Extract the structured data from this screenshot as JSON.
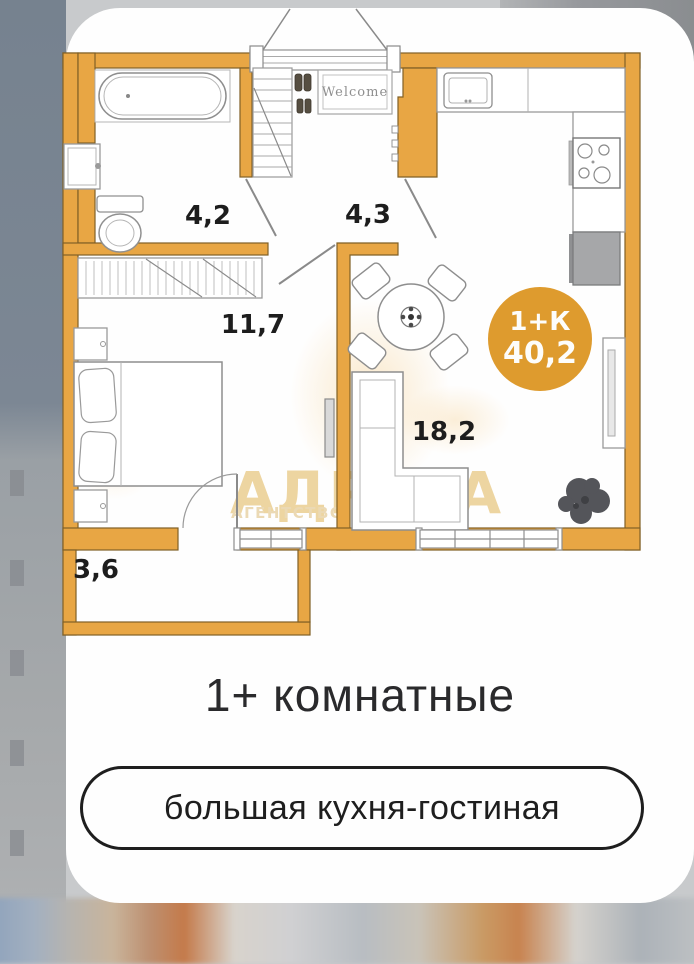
{
  "plan": {
    "rooms": [
      {
        "name": "bathroom",
        "area": "4,2"
      },
      {
        "name": "hallway",
        "area": "4,3"
      },
      {
        "name": "bedroom",
        "area": "11,7"
      },
      {
        "name": "kitchen-living",
        "area": "18,2"
      },
      {
        "name": "balcony",
        "area": "3,6"
      }
    ],
    "badge": {
      "type": "1+К",
      "total_area": "40,2"
    },
    "welcome_mat": "Welcome",
    "watermark": {
      "title": "АДРЕСА",
      "subtitle": "АГЕНТСТВО Н"
    }
  },
  "footer": {
    "heading": "1+ комнатные",
    "feature_pill": "большая кухня-гостиная"
  },
  "colors": {
    "wall": "#e8a644",
    "badge": "#de9b2e",
    "watermark_text": "#edd5a1"
  }
}
